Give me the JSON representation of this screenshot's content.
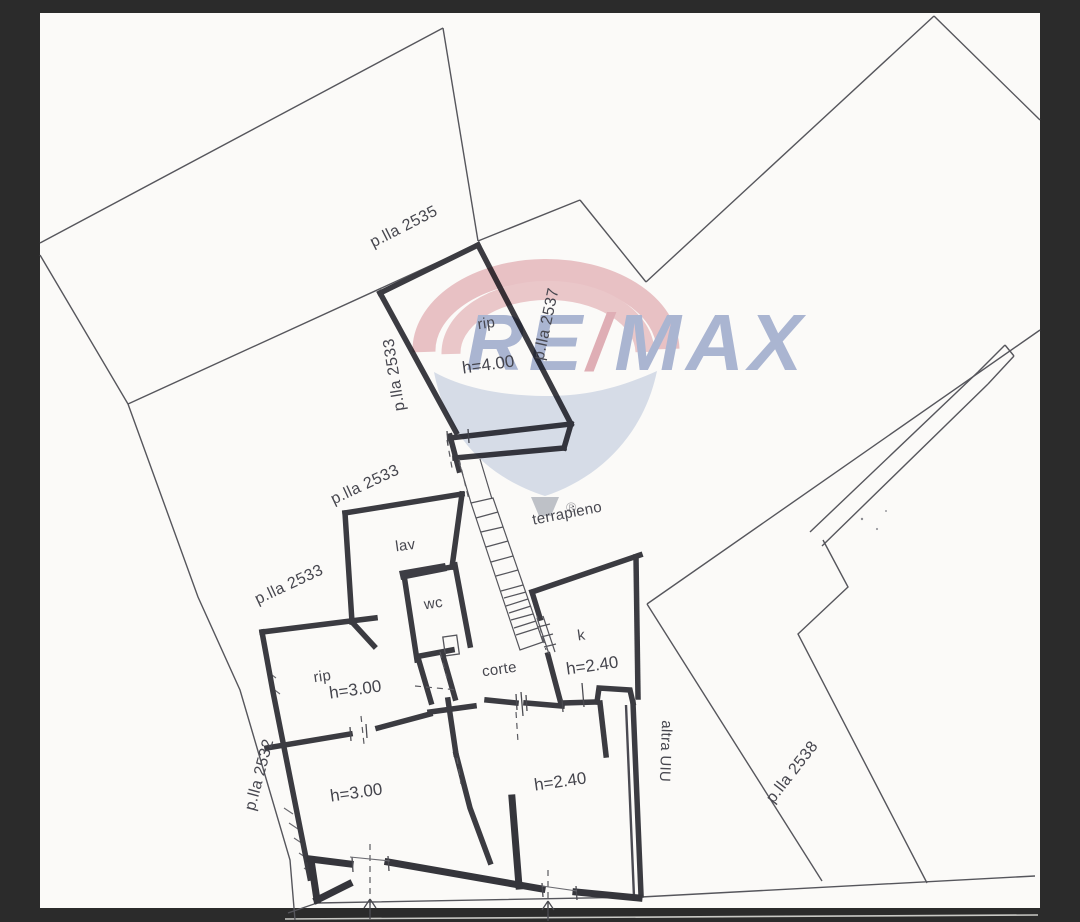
{
  "document_kind": "cadastral floor plan sheet",
  "colors": {
    "letterbox": "#2b2b2b",
    "sheet": "#fbfaf8",
    "wall": "#3b3b41",
    "parcel_line": "#56565c",
    "label_text": "#47474f",
    "sheet_edge_line": "#c8c8c4"
  },
  "parcel_labels": [
    "p.lla 2535",
    "p.lla 2533",
    "p.lla 2533",
    "p.lla 2533",
    "p.lla 2532",
    "p.lla 2537",
    "p.lla 2538"
  ],
  "room_labels": [
    "rip",
    "h=4.00",
    "terrapieno",
    "lav",
    "wc",
    "k",
    "h=2.40",
    "corte",
    "rip",
    "h=3.00",
    "h=3.00",
    "h=2.40",
    "altra UIU"
  ],
  "watermark": {
    "brand_left": "RE",
    "brand_slash": "/",
    "brand_right": "MAX",
    "registered_mark": "®",
    "text_blue": "#7b8dbf",
    "slash_red": "#d2838f",
    "balloon_pink": "#e0a2aa",
    "balloon_body_blue": "#c3cfe4",
    "basket_gray": "#9aa1ae"
  },
  "symbols": {
    "entrance_arrow_icon": "↑",
    "entrance_arrow_count": 2
  }
}
